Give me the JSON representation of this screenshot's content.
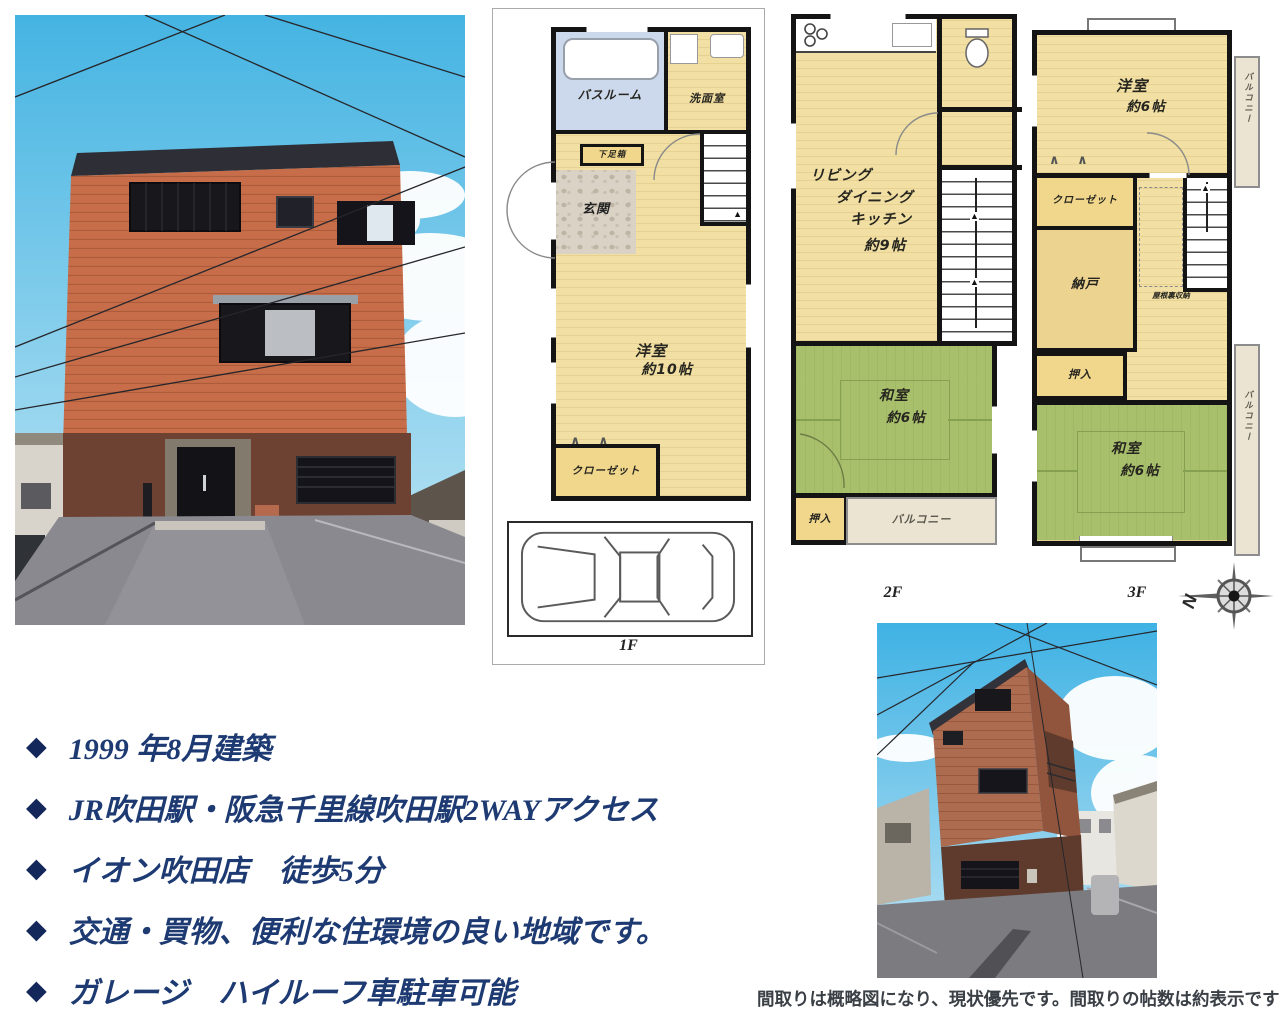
{
  "bullet_marker": "◆",
  "features": [
    "1999 年8月建築",
    "JR吹田駅・阪急千里線吹田駅2WAYアクセス",
    "イオン吹田店　徒歩5分",
    "交通・買物、便利な住環境の良い地域です。",
    "ガレージ　ハイルーフ車駐車可能"
  ],
  "disclaimer": "間取りは概略図になり、現状優先です。間取りの帖数は約表示です",
  "compass": {
    "north_label": "N"
  },
  "floorplans": {
    "f1": {
      "floor_label": "1F",
      "bathroom": "バスルーム",
      "washroom": "洗面室",
      "shoe_cabinet": "下足箱",
      "entrance": "玄関",
      "western_room": "洋室",
      "western_room_size": "約10帖",
      "closet": "クローゼット"
    },
    "f2": {
      "floor_label": "2F",
      "living": "リビング",
      "dining": "ダイニング",
      "kitchen": "キッチン",
      "ldk_size": "約9帖",
      "japanese_room": "和室",
      "japanese_room_size": "約6帖",
      "oshiire": "押入",
      "balcony": "バルコニー"
    },
    "f3": {
      "floor_label": "3F",
      "western_room": "洋室",
      "western_room_size": "約6帖",
      "closet": "クローゼット",
      "storage_room": "納戸",
      "attic_storage": "屋根裏収納",
      "oshiire": "押入",
      "japanese_room": "和室",
      "japanese_room_size": "約6帖",
      "balcony_side": "バルコニー",
      "balcony_lower": "バルコニー"
    }
  },
  "colors": {
    "feature_text": "#1e3a72",
    "bullet_diamond": "#14275a",
    "wood_floor": "#f1dfa3",
    "tatami_green": "#a8c06c",
    "bath_blue": "#ccd9ec",
    "balcony_beige": "#ece4d2",
    "closet_fill": "#f0d78c",
    "wall_black": "#141414",
    "house_upper": "#c76d49",
    "house_lower": "#6e4232",
    "sky_blue": "#4fb7e3"
  }
}
